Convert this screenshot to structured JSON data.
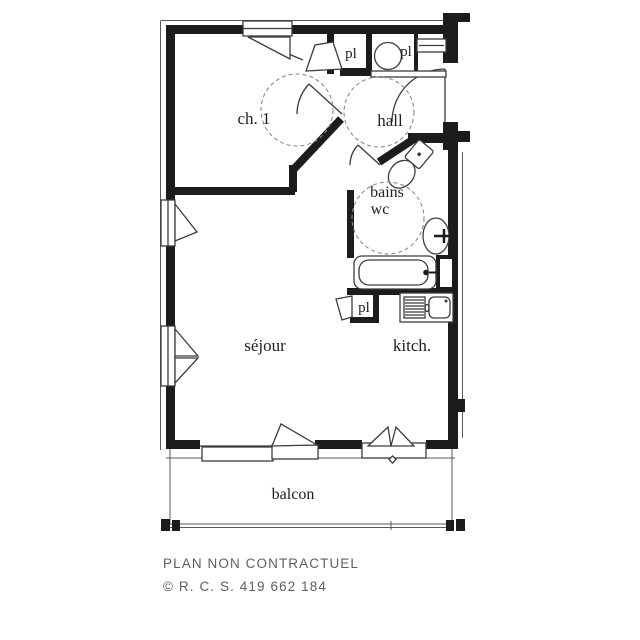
{
  "rooms": {
    "bedroom": {
      "label": "ch. 1"
    },
    "hall": {
      "label": "hall"
    },
    "bathroom": {
      "line1": "bains",
      "line2": "wc"
    },
    "living_room": {
      "label": "séjour"
    },
    "kitchen": {
      "label": "kitch."
    },
    "balcony": {
      "label": "balcon"
    },
    "closet_bedroom": {
      "label": "pl"
    },
    "closet_hall": {
      "label": "pl"
    },
    "closet_kitchen": {
      "label": "pl"
    }
  },
  "fixtures": {
    "bathtub": "bathtub",
    "toilet": "toilet",
    "washbasin": "washbasin",
    "kitchen_sink": "kitchen-sink-with-drainboard",
    "water_heater": "water-heater"
  },
  "footer": {
    "disclaimer": "PLAN NON CONTRACTUEL",
    "registration": "© R. C. S. 419 662 184"
  },
  "colors": {
    "wall": "#1c1c1c",
    "symbol_line": "#3c3c3c",
    "dashed_circle": "#8a8a8a",
    "background": "#ffffff",
    "footer_text": "#5c6063"
  }
}
